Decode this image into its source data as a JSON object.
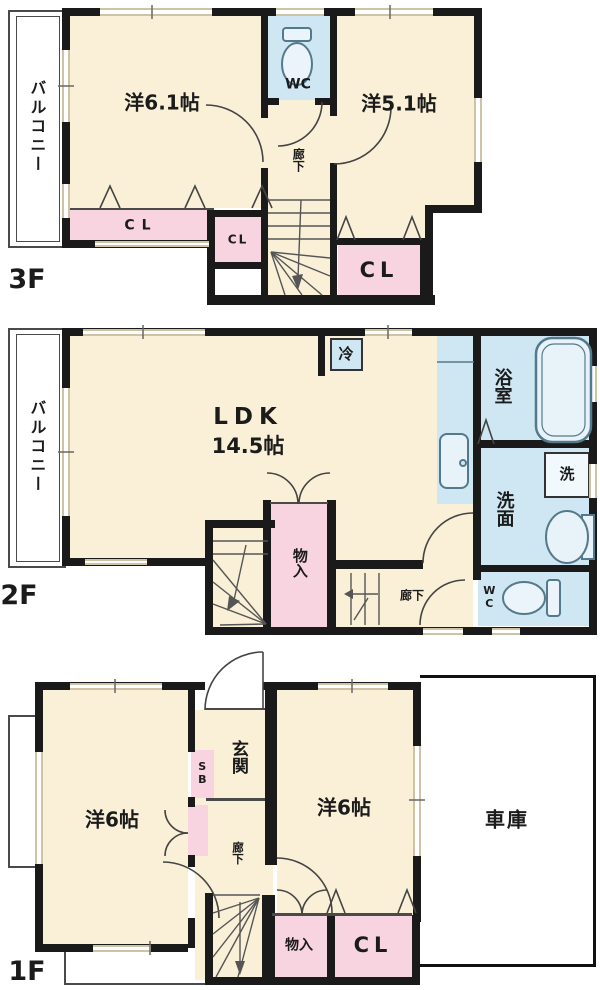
{
  "title": "3-story house floor plan",
  "f3": {
    "floor_label": "3F",
    "balcony": "バルコニー",
    "room_61": "洋6.1帖",
    "room_51": "洋5.1帖",
    "wc": "WC",
    "hallway": "廊下",
    "closet_wide": "CL",
    "closet_small": "CL",
    "closet_right": "CL"
  },
  "f2": {
    "floor_label": "2F",
    "balcony": "バルコニー",
    "ldk_line1": "LDK",
    "ldk_line2": "14.5帖",
    "fridge": "冷",
    "bathroom": "浴室",
    "washroom": "洗面",
    "washer": "洗",
    "wc": "WC",
    "storage": "物入",
    "hallway": "廊下"
  },
  "f1": {
    "floor_label": "1F",
    "entrance": "玄関",
    "shoe_box": "SB",
    "room_left": "洋6帖",
    "room_right": "洋6帖",
    "garage": "車庫",
    "hallway": "廊下",
    "storage": "物入",
    "closet": "CL"
  },
  "colors": {
    "room_fill": "#faf0d8",
    "closet_fill": "#f8d3e0",
    "wet_area_fill": "#cfe7f2",
    "wall": "#1a1a1a",
    "window_frame": "#cfc3a5"
  }
}
